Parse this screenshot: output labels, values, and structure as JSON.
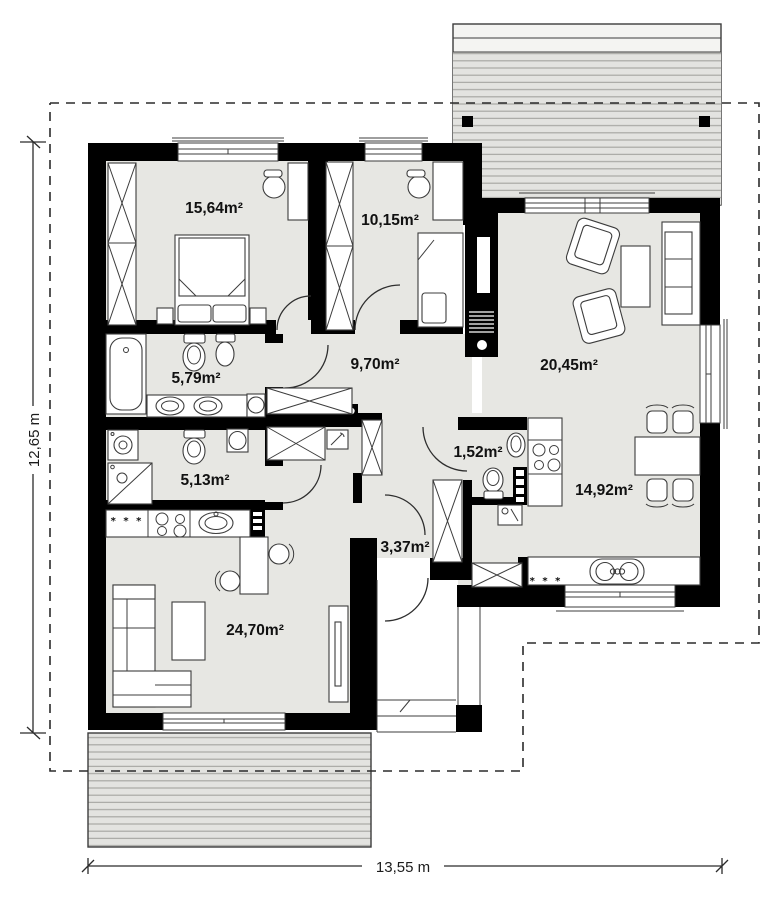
{
  "plan": {
    "type": "single-storey house floor plan",
    "total_width_label": "13,55 m",
    "total_height_label": "12,65 m"
  },
  "colors": {
    "wall": "#000000",
    "floor": "#e7e7e3",
    "terrace_fill": "#e3e3e0",
    "terrace_hatch_line": "#a8a8a4",
    "outline": "#3c3c3c",
    "boundary_dash": "#2b2b2b"
  },
  "rooms": [
    {
      "name": "bedroom-main",
      "area_label": "15,64m²"
    },
    {
      "name": "bedroom-second",
      "area_label": "10,15m²"
    },
    {
      "name": "hallway",
      "area_label": "9,70m²"
    },
    {
      "name": "bathroom",
      "area_label": "5,79m²"
    },
    {
      "name": "utility-room",
      "area_label": "5,13m²"
    },
    {
      "name": "wc",
      "area_label": "1,52m²"
    },
    {
      "name": "living-room",
      "area_label": "20,45m²"
    },
    {
      "name": "kitchen-dining",
      "area_label": "14,92m²"
    },
    {
      "name": "family-room",
      "area_label": "24,70m²"
    },
    {
      "name": "entrance-hall",
      "area_label": "3,37m²"
    }
  ],
  "dimensions": {
    "vertical": "12,65 m",
    "horizontal": "13,55 m"
  },
  "symbols": {
    "appliance_marks": "* * *"
  }
}
